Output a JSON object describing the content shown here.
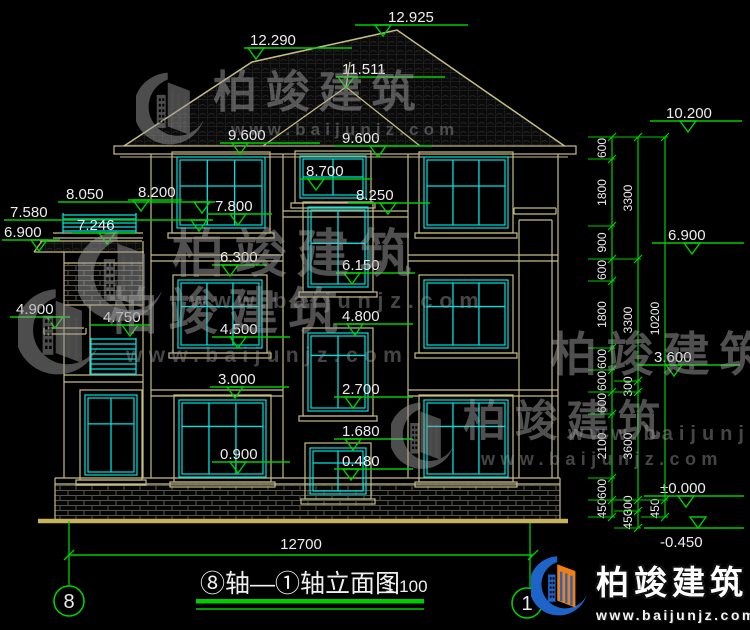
{
  "canvas": {
    "w": 750,
    "h": 630,
    "bg": "#000000"
  },
  "colors": {
    "line": "#C6BC86",
    "ground": "#C8B25C",
    "cyan": "#00E2E2",
    "green": "#00CE00",
    "text": "#EDEDED",
    "tile": "#2c2c2c",
    "brick": "#55554a"
  },
  "markers": [
    {
      "v": "12.925",
      "tx": 388,
      "ty": 22,
      "l": [
        355,
        468,
        25
      ],
      "a": 383
    },
    {
      "v": "12.290",
      "tx": 250,
      "ty": 45,
      "l": [
        244,
        352,
        48
      ],
      "a": 256
    },
    {
      "v": "11.511",
      "tx": 342,
      "ty": 74,
      "l": [
        336,
        445,
        77
      ],
      "a": 346
    },
    {
      "v": "9.600",
      "tx": 228,
      "ty": 140,
      "l": [
        220,
        320,
        143
      ],
      "a": 240
    },
    {
      "v": "9.600",
      "tx": 342,
      "ty": 143,
      "l": [
        334,
        432,
        146
      ],
      "a": 378
    },
    {
      "v": "8.700",
      "tx": 306,
      "ty": 176,
      "l": [
        300,
        372,
        179
      ],
      "a": 316
    },
    {
      "v": "8.250",
      "tx": 356,
      "ty": 200,
      "l": [
        348,
        430,
        203
      ],
      "a": 388
    },
    {
      "v": "7.800",
      "tx": 215,
      "ty": 211,
      "l": [
        207,
        272,
        214
      ],
      "a": 238
    },
    {
      "v": "8.050",
      "tx": 66,
      "ty": 199,
      "l": [
        58,
        215,
        202
      ],
      "a": 202
    },
    {
      "v": "8.200",
      "tx": 138,
      "ty": 197,
      "l": [
        128,
        182,
        200
      ],
      "a": 141
    },
    {
      "v": "7.580",
      "tx": 10,
      "ty": 217,
      "l": [
        4,
        213,
        220
      ],
      "a": 199
    },
    {
      "v": "7.246",
      "tx": 77,
      "ty": 230,
      "l": [
        72,
        135,
        233
      ],
      "a": 107
    },
    {
      "v": "6.900",
      "tx": 4,
      "ty": 237,
      "l": [
        2,
        60,
        240
      ],
      "a": 39
    },
    {
      "v": "6.300",
      "tx": 220,
      "ty": 262,
      "l": [
        212,
        267,
        265
      ],
      "a": 230
    },
    {
      "v": "6.150",
      "tx": 342,
      "ty": 270,
      "l": [
        336,
        415,
        273
      ],
      "a": 352
    },
    {
      "v": "4.900",
      "tx": 16,
      "ty": 314,
      "l": [
        10,
        70,
        317
      ],
      "a": 55
    },
    {
      "v": "4.750",
      "tx": 103,
      "ty": 322,
      "l": [
        90,
        150,
        325
      ],
      "a": 130
    },
    {
      "v": "4.800",
      "tx": 342,
      "ty": 321,
      "l": [
        334,
        413,
        324
      ],
      "a": 355
    },
    {
      "v": "4.500",
      "tx": 220,
      "ty": 334,
      "l": [
        212,
        290,
        337
      ],
      "a": 238
    },
    {
      "v": "3.000",
      "tx": 218,
      "ty": 384,
      "l": [
        210,
        289,
        387
      ],
      "a": 235
    },
    {
      "v": "2.700",
      "tx": 342,
      "ty": 394,
      "l": [
        334,
        413,
        397
      ],
      "a": 353
    },
    {
      "v": "1.680",
      "tx": 342,
      "ty": 436,
      "l": [
        334,
        413,
        439
      ],
      "a": 353
    },
    {
      "v": "0.900",
      "tx": 220,
      "ty": 459,
      "l": [
        212,
        290,
        462
      ],
      "a": 238
    },
    {
      "v": "0.480",
      "tx": 342,
      "ty": 466,
      "l": [
        334,
        413,
        469
      ],
      "a": 351
    },
    {
      "v": "10.200",
      "tx": 666,
      "ty": 118,
      "l": [
        650,
        742,
        121
      ],
      "a": 688
    },
    {
      "v": "6.900",
      "tx": 668,
      "ty": 240,
      "l": [
        652,
        744,
        243
      ],
      "a": 692
    },
    {
      "v": "3.600",
      "tx": 654,
      "ty": 362,
      "l": [
        638,
        740,
        365
      ],
      "a": 674
    },
    {
      "v": "±0.000",
      "tx": 660,
      "ty": 493,
      "l": [
        644,
        744,
        496
      ],
      "a": 686
    },
    {
      "v": "-0.450",
      "tx": 660,
      "ty": 547,
      "l": [
        644,
        744,
        528
      ],
      "a": 698,
      "flip": 1
    }
  ],
  "dim_chains": [
    {
      "x": 612,
      "segs": [
        [
          "600",
          137,
          159
        ],
        [
          "1800",
          159,
          226
        ],
        [
          "900",
          226,
          259
        ],
        [
          "600",
          259,
          281
        ],
        [
          "1800",
          281,
          348
        ],
        [
          "600",
          348,
          370
        ],
        [
          "600",
          370,
          392
        ],
        [
          "600",
          392,
          414
        ],
        [
          "2100",
          414,
          478
        ],
        [
          "600",
          478,
          500
        ],
        [
          "450",
          500,
          517
        ]
      ]
    },
    {
      "x": 638,
      "segs": [
        [
          "3300",
          137,
          259
        ],
        [
          "3300",
          259,
          381
        ],
        [
          "300",
          381,
          392
        ],
        [
          "3600",
          392,
          500
        ],
        [
          "300",
          500,
          511
        ],
        [
          "450",
          511,
          528
        ]
      ]
    },
    {
      "x": 665,
      "segs": [
        [
          "10200",
          137,
          500
        ],
        [
          "450",
          500,
          517
        ]
      ]
    }
  ],
  "bottom": {
    "dim_value": "12700",
    "dim": {
      "y": 555,
      "x1": 69,
      "x2": 533,
      "tx": 301,
      "ty": 549
    },
    "axes": [
      {
        "label": "8",
        "cx": 69,
        "cy": 601,
        "r": 15,
        "line": [
          69,
          521,
          586
        ]
      },
      {
        "label": "1",
        "cx": 527,
        "cy": 603,
        "r": 15,
        "line": [
          530,
          523,
          588
        ]
      }
    ]
  },
  "title": {
    "text": "⑧轴—①轴立面图",
    "scale": "1:100"
  },
  "watermark": {
    "name": "柏竣建筑",
    "url": "www.baijunjz.com",
    "stamps": [
      {
        "x": 136,
        "y": 70,
        "icon": true,
        "icon_h": 80,
        "size": 44,
        "url_size": 17,
        "url_mt": 4
      },
      {
        "x": 78,
        "y": 228,
        "icon": true,
        "icon_h": 100,
        "size": 52,
        "url_size": 22,
        "url_mt": 5
      },
      {
        "x": 18,
        "y": 286,
        "icon": true,
        "icon_h": 95,
        "size": 50,
        "url_size": 21,
        "url_mt": 5
      },
      {
        "x": 550,
        "y": 330,
        "icon": false,
        "icon_h": 0,
        "size": 47,
        "url_size": 20,
        "url_mt": 44
      },
      {
        "x": 391,
        "y": 400,
        "icon": true,
        "icon_h": 74,
        "size": 43,
        "url_size": 18,
        "url_mt": 4
      }
    ]
  },
  "logo": {
    "name": "柏竣建筑",
    "url": "www.baijunjz.com",
    "blue": "#1E63C8",
    "orange": "#F07E12"
  }
}
